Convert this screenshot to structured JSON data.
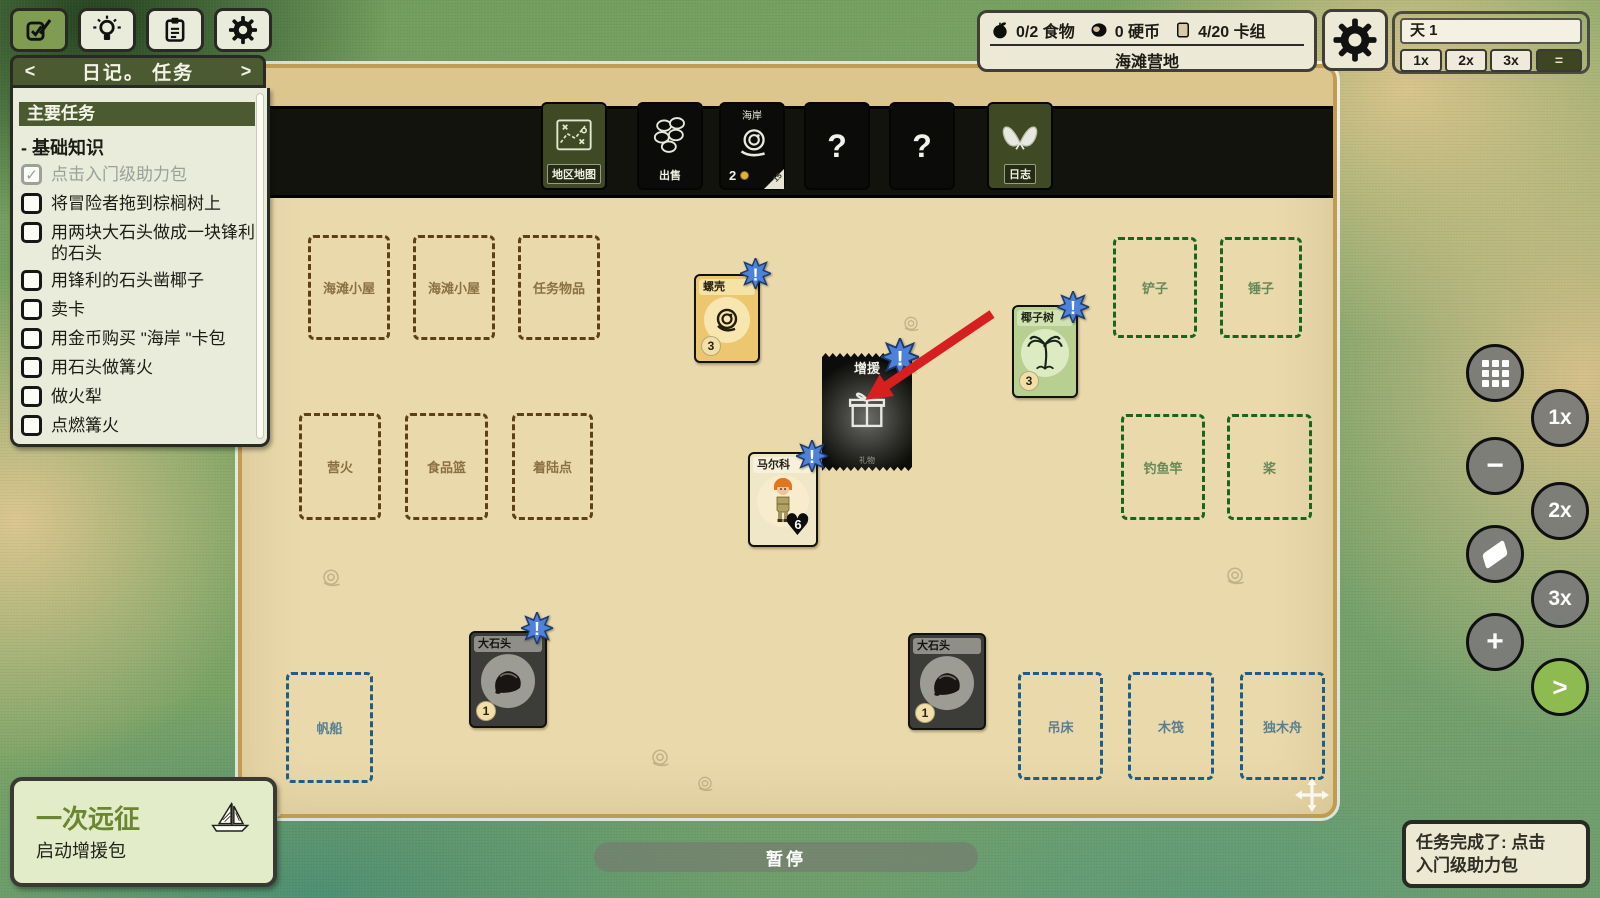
{
  "toolbar": {
    "tabs": [
      {
        "id": "tasks",
        "icon": "checklist-icon",
        "active": true
      },
      {
        "id": "ideas",
        "icon": "lightbulb-icon",
        "active": false
      },
      {
        "id": "cardlist",
        "icon": "clipboard-icon",
        "active": false
      },
      {
        "id": "settings",
        "icon": "gear-icon",
        "active": false
      }
    ]
  },
  "journal": {
    "prev_label": "<",
    "next_label": ">",
    "title": "日记。 任务",
    "section_title": "主要任务",
    "group_title": "- 基础知识",
    "tasks": [
      {
        "label": "点击入门级助力包",
        "checked": true
      },
      {
        "label": "将冒险者拖到棕榈树上",
        "checked": false
      },
      {
        "label": "用两块大石头做成一块锋利的石头",
        "checked": false
      },
      {
        "label": "用锋利的石头凿椰子",
        "checked": false
      },
      {
        "label": "卖卡",
        "checked": false
      },
      {
        "label": "用金币购买 \"海岸 \"卡包",
        "checked": false
      },
      {
        "label": "用石头做篝火",
        "checked": false
      },
      {
        "label": "做火犁",
        "checked": false
      },
      {
        "label": "点燃篝火",
        "checked": false
      }
    ]
  },
  "status": {
    "food": "0/2 食物",
    "coins": "0 硬币",
    "deck": "4/20 卡组",
    "location": "海滩营地"
  },
  "time": {
    "day": "天 1",
    "speed_1x": "1x",
    "speed_2x": "2x",
    "speed_3x": "3x",
    "speed_pause": "=",
    "active_speed": "="
  },
  "packs": {
    "map": {
      "label": "地区地图"
    },
    "sell": {
      "label": "出售"
    },
    "coast": {
      "label": "海岸",
      "count": "2",
      "corner": "15"
    },
    "q1": {
      "label": "?"
    },
    "q2": {
      "label": "?"
    },
    "log": {
      "label": "日志"
    }
  },
  "slots": [
    {
      "label": "海滩小屋",
      "color": "brown"
    },
    {
      "label": "海滩小屋",
      "color": "brown"
    },
    {
      "label": "任务物品",
      "color": "brown"
    },
    {
      "label": "营火",
      "color": "brown"
    },
    {
      "label": "食品篮",
      "color": "brown"
    },
    {
      "label": "着陆点",
      "color": "brown"
    },
    {
      "label": "铲子",
      "color": "green"
    },
    {
      "label": "锤子",
      "color": "green"
    },
    {
      "label": "钓鱼竿",
      "color": "green"
    },
    {
      "label": "桨",
      "color": "green"
    },
    {
      "label": "帆船",
      "color": "blue"
    },
    {
      "label": "吊床",
      "color": "blue"
    },
    {
      "label": "木筏",
      "color": "blue"
    },
    {
      "label": "独木舟",
      "color": "blue"
    }
  ],
  "cards": {
    "shell": {
      "title": "螺壳",
      "count": "3"
    },
    "boost": {
      "title": "增援",
      "subtitle": "礼物"
    },
    "coconut": {
      "title": "椰子树",
      "count": "3"
    },
    "marko": {
      "title": "马尔科",
      "health": "6"
    },
    "rock1": {
      "title": "大石头",
      "count": "1"
    },
    "rock2": {
      "title": "大石头",
      "count": "1"
    }
  },
  "side_buttons": {
    "zoom_1x": "1x",
    "zoom_2x": "2x",
    "zoom_3x": "3x",
    "next": ">"
  },
  "expedition": {
    "title": "一次远征",
    "subtitle": "启动增援包"
  },
  "pause_label": "暂停",
  "notification": {
    "line1": "任务完成了: 点击",
    "line2": "入门级助力包"
  },
  "colors": {
    "accent_green": "#7f9c50",
    "star_blue": "#4d82d8",
    "arrow_red": "#d81f1f",
    "slot_brown": "#5f4016",
    "slot_green": "#17661c",
    "slot_blue": "#1d5d86",
    "board_sand": "#e9d9ab"
  }
}
